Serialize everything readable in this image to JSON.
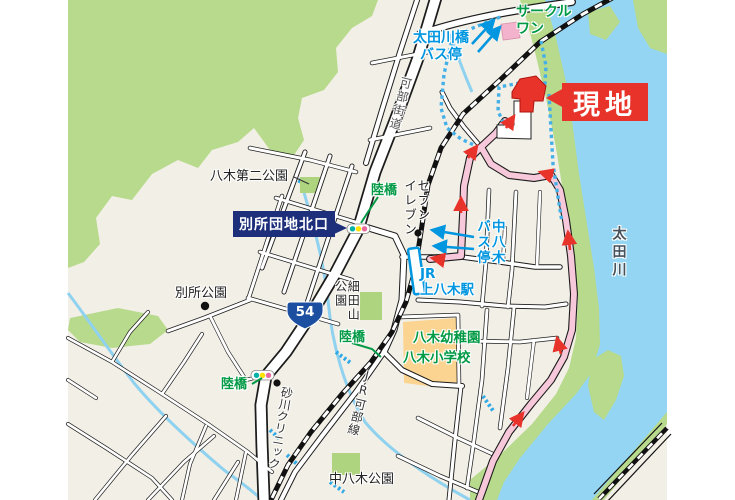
{
  "map": {
    "site_label": "現地",
    "landmarks": {
      "circle_one": "サークル\nワン",
      "seven_eleven": "セブン\nイレブン",
      "sunagawa_clinic": "砂川クリニック",
      "yagi_kindergarten": "八木幼稚園",
      "yagi_elementary_school": "八木小学校"
    },
    "transit": {
      "otagawa_bridge_bus_stop": "太田川橋\nバス停",
      "naka_yagi_bus_stop": "中八木\nバス停",
      "jr_kamiyagi_station": "JR\n上八木駅",
      "jr_kabe_line": "JR可部線"
    },
    "roads": {
      "kabe_kaido": "可部街道",
      "route_54": "54",
      "bessho_danchi_north_exit": "別所団地北口",
      "overpass_north": "陸橋",
      "overpass_middle": "陸橋",
      "overpass_south": "陸橋"
    },
    "parks": {
      "yagi_daini_park": "八木第二公園",
      "bessho_park": "別所公園",
      "hosodayama_park": "細田山\n公園",
      "naka_yagi_park": "中八木公園"
    },
    "river": "太田川",
    "colors": {
      "land": "#f2efe6",
      "green_area": "#b8da8c",
      "water": "#93d5f2",
      "road_fill": "#ffffff",
      "road_casing": "#1c1c1c",
      "bus_route_pink": "#f6c8da",
      "site_red": "#e8332a",
      "label_navy": "#1d2e7b",
      "transit_blue": "#0096e0",
      "map_green_text": "#009944",
      "school_orange": "#fbd492",
      "signal_teal": "#00b2a8",
      "signal_yellow": "#ffe200",
      "signal_pink": "#e96a9c",
      "route_shield_blue": "#1c4fa0",
      "walk_route_blue": "#45b0e8"
    }
  }
}
